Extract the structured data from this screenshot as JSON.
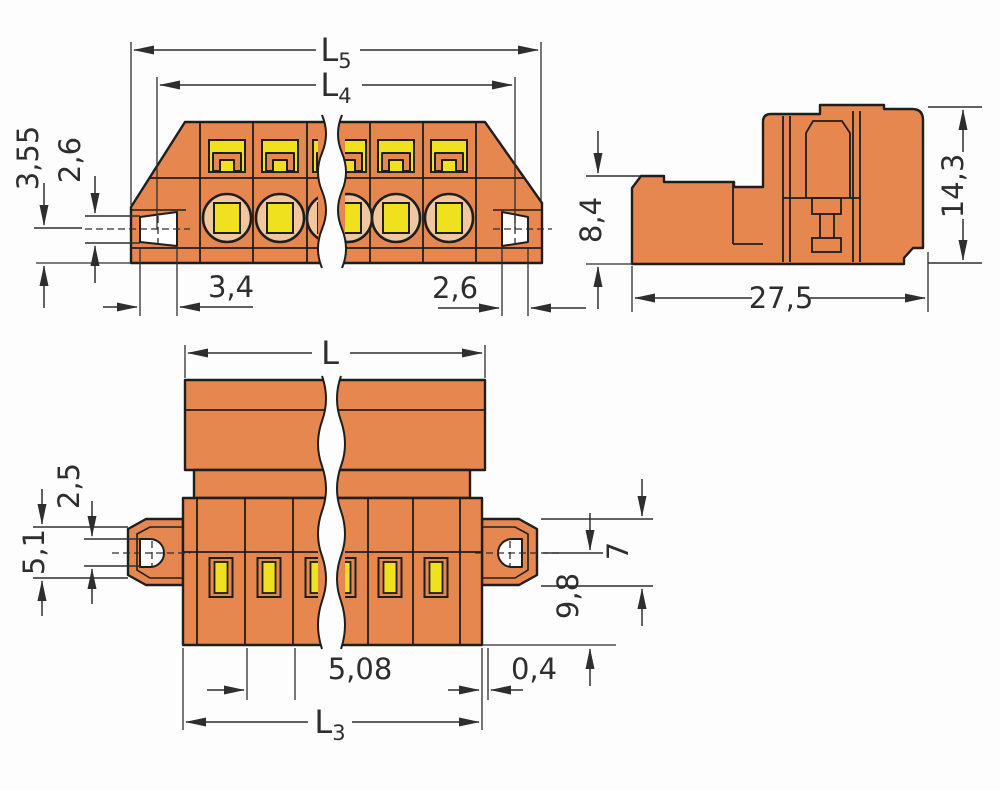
{
  "drawing": {
    "kind": "connector-dimension-drawing",
    "views": [
      "front-view",
      "side-view",
      "bottom-view"
    ]
  },
  "colors": {
    "body": "#E6874F",
    "highlight": "#F0E11E",
    "bore": "#F3C79E",
    "ink": "#1e1e1e",
    "dim": "#2e2e2e",
    "bg": "#FDFDFD",
    "hole": "#FFFFFF"
  },
  "labels": {
    "L5": {
      "main": "L",
      "sub": "5"
    },
    "L4": {
      "main": "L",
      "sub": "4"
    },
    "L": {
      "main": "L",
      "sub": ""
    },
    "L3": {
      "main": "L",
      "sub": "3"
    },
    "front_355": "3,55",
    "front_26_left": "2,6",
    "front_34": "3,4",
    "front_26_right": "2,6",
    "side_84": "8,4",
    "side_143": "14,3",
    "side_275": "27,5",
    "bottom_25": "2,5",
    "bottom_51": "5,1",
    "bottom_7": "7",
    "bottom_98": "9,8",
    "bottom_508": "5,08",
    "bottom_04": "0,4"
  }
}
